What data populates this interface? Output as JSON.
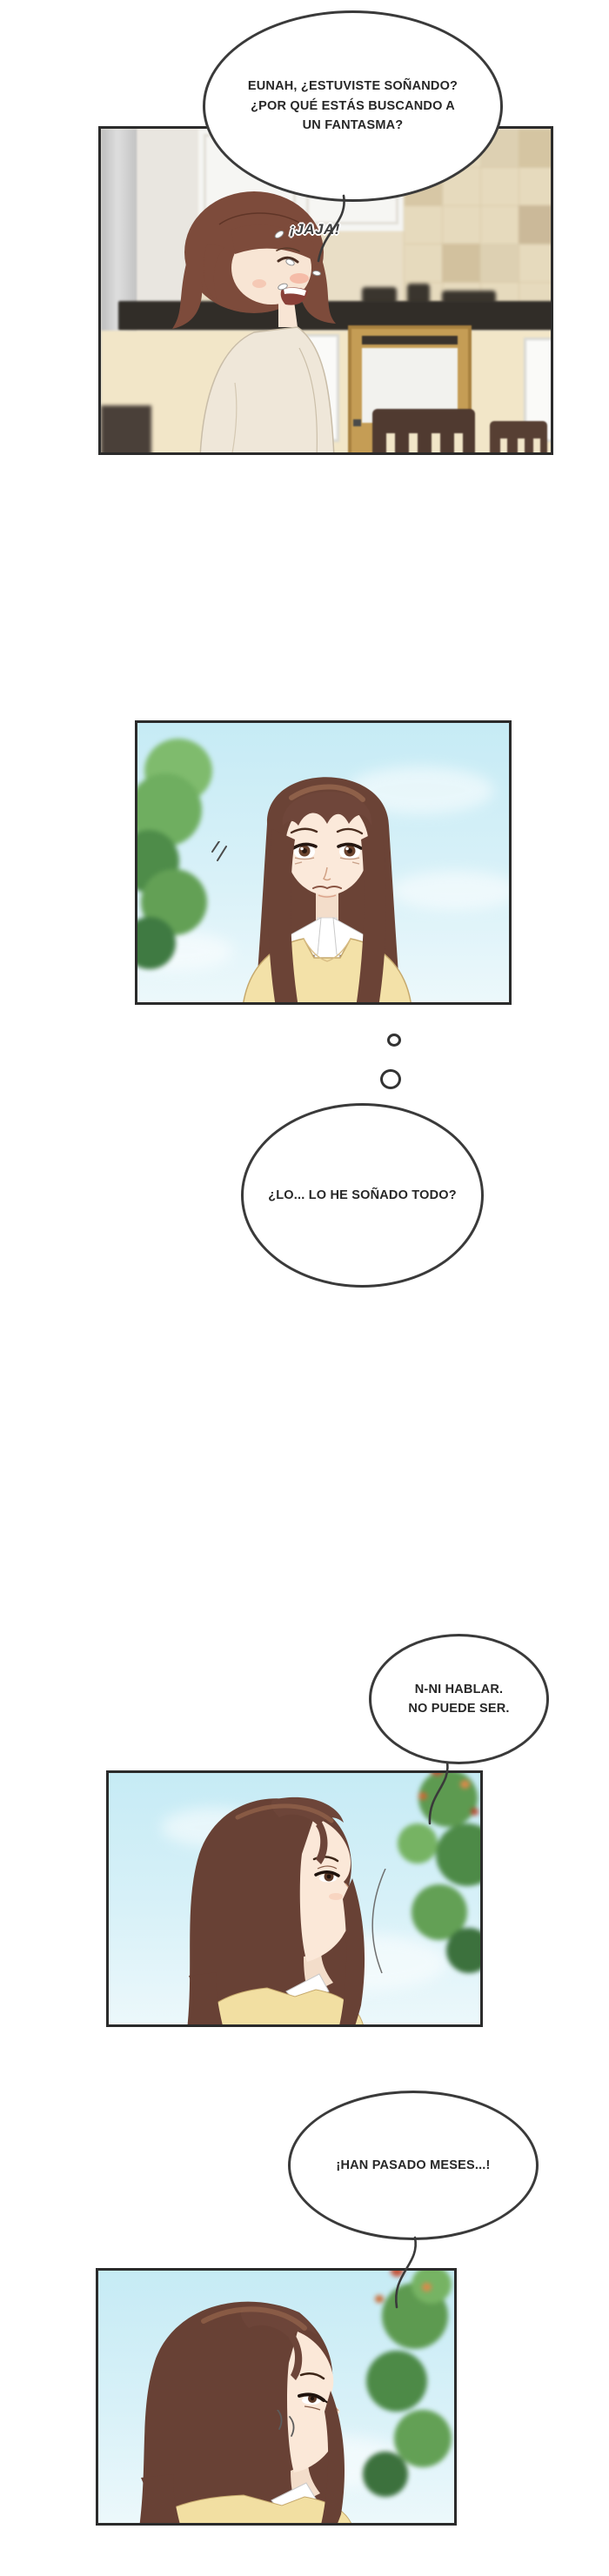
{
  "comic": {
    "speech_top": {
      "line1": "EUNAH, ¿ESTUVISTE SOÑANDO?",
      "line2": "¿POR QUÉ ESTÁS BUSCANDO A",
      "line3": "UN FANTASMA?"
    },
    "laugh": "¡JAJA!",
    "thought": "¿LO... LO HE SOÑADO TODO?",
    "speech_disbelief": {
      "line1": "N-NI HABLAR.",
      "line2": "NO PUEDE SER."
    },
    "speech_months": "¡HAN PASADO MESES...!"
  },
  "colors": {
    "panel_border": "#2b2b2b",
    "bubble_stroke": "#3a3a3a",
    "text": "#272727",
    "sky_blue": "#c6ebf5",
    "hair_brown": "#6b4336",
    "sweater_yellow": "#f3e1a8",
    "tree_green": "#5d9a50",
    "tile_beige": "#e6dabd",
    "counter_dark": "#312d28",
    "wood_cabinet": "#c59d55"
  }
}
